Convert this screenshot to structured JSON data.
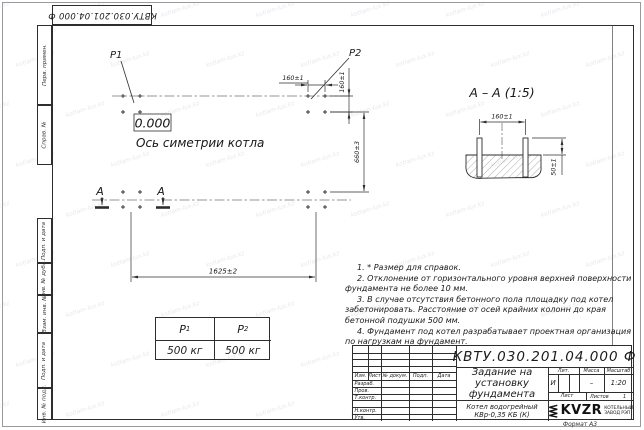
{
  "sheet": {
    "top_doc_number": "КВТУ.030.201.04.000 Ф",
    "format_label": "Формат А3",
    "side_stamp": [
      "Перв. примен.",
      "Справ. №",
      "Подп. и дата",
      "Инв. № дубл.",
      "Взам. инв. №",
      "Подп. и дата",
      "Инв. № подл."
    ]
  },
  "plan": {
    "p1": "P1",
    "p2": "P2",
    "level_mark": "0.000",
    "axis_label": "Ось симетрии котла",
    "dim_bolt_horizontal": "160±1",
    "dim_bolt_vertical": "160±1",
    "dim_depth": "660±3",
    "dim_length": "1625±2",
    "section_letter": "А"
  },
  "section": {
    "title": "А – А (1:5)",
    "dim_bolt_spacing": "160±1",
    "dim_protrusion": "50±1"
  },
  "loads": {
    "p1_label": "P",
    "p1_sub": "1",
    "p1_value": "500 кг",
    "p2_label": "P",
    "p2_sub": "2",
    "p2_value": "500 кг"
  },
  "notes": [
    "1. * Размер для справок.",
    "2. Отклонение от горизонтального уровня верхней поверхности фундамента не более 10 мм.",
    "3. В случае отсутствия бетонного пола площадку под котел забетонировать. Расстояние от осей крайних колонн до края бетонной подушки 500 мм.",
    "4. Фундамент под котел разрабатывает проектная организация по нагрузкам на фундамент."
  ],
  "title_block": {
    "doc_number": "КВТУ.030.201.04.000 Ф",
    "title_lines": [
      "Задание на",
      "установку",
      "фундамента"
    ],
    "product_lines": [
      "Котел водогрейный",
      "КВр-0,35 КБ (К)"
    ],
    "header_cols": [
      "Изм.",
      "Лист",
      "№ докум.",
      "Подп.",
      "Дата"
    ],
    "rows": [
      "Разраб.",
      "Пров.",
      "Т.контр.",
      "",
      "Н.контр.",
      "Утв."
    ],
    "lit_label": "Лит.",
    "lit_value": "И",
    "mass_label": "Масса",
    "mass_value": "–",
    "scale_label": "Масштаб",
    "scale_value": "1:20",
    "sheet_label": "Лист",
    "sheets_label": "Листов",
    "sheets_value": "1",
    "logo_text": "KVZR",
    "logo_sub": [
      "КОТЕЛЬНЫЙ",
      "ЗАВОД РЭП"
    ]
  },
  "watermark": "kotlam-lux.kz",
  "colors": {
    "line": "#2e2e2e",
    "text": "#1a1a1a",
    "watermark": "#7d879e"
  }
}
